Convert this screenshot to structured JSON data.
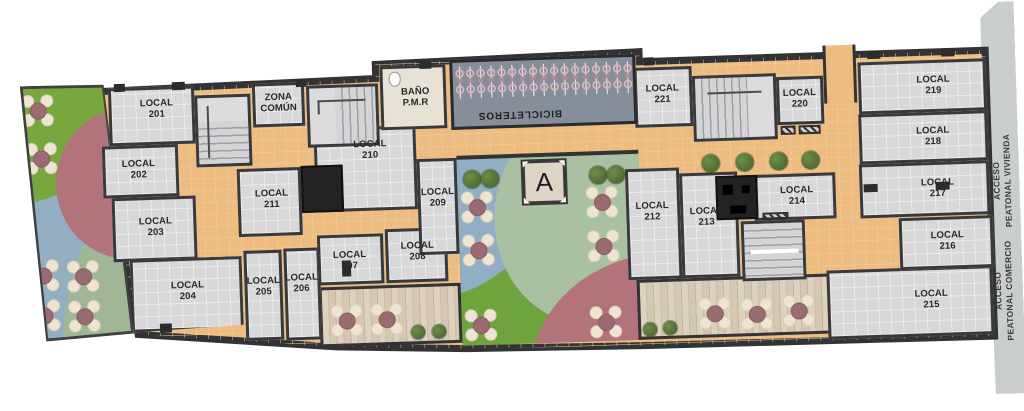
{
  "plan": {
    "locals": [
      {
        "name": "LOCAL",
        "number": "201"
      },
      {
        "name": "LOCAL",
        "number": "202"
      },
      {
        "name": "LOCAL",
        "number": "203"
      },
      {
        "name": "LOCAL",
        "number": "204"
      },
      {
        "name": "LOCAL",
        "number": "205"
      },
      {
        "name": "LOCAL",
        "number": "206"
      },
      {
        "name": "LOCAL",
        "number": "207"
      },
      {
        "name": "LOCAL",
        "number": "208"
      },
      {
        "name": "LOCAL",
        "number": "209"
      },
      {
        "name": "LOCAL",
        "number": "210"
      },
      {
        "name": "LOCAL",
        "number": "211"
      },
      {
        "name": "LOCAL",
        "number": "212"
      },
      {
        "name": "LOCAL",
        "number": "213"
      },
      {
        "name": "LOCAL",
        "number": "214"
      },
      {
        "name": "LOCAL",
        "number": "215"
      },
      {
        "name": "LOCAL",
        "number": "216"
      },
      {
        "name": "LOCAL",
        "number": "217"
      },
      {
        "name": "LOCAL",
        "number": "218"
      },
      {
        "name": "LOCAL",
        "number": "219"
      },
      {
        "name": "LOCAL",
        "number": "220"
      },
      {
        "name": "LOCAL",
        "number": "221"
      }
    ],
    "zones": {
      "zona_comun_line1": "ZONA",
      "zona_comun_line2": "COMÚN",
      "bano_line1": "BAÑO",
      "bano_line2": "P.M.R",
      "bicicleteros": "BICICLETEROS",
      "marker_a": "A"
    },
    "access": {
      "vivienda_line1": "ACCESO",
      "vivienda_line2": "PEATONAL VIVIENDA",
      "comercio_line1": "ACCESO",
      "comercio_line2": "PEATONAL COMERCIO"
    },
    "colors": {
      "wall": "#39393b",
      "room_floor": "#d8d8da",
      "corridor": "#ecbc81",
      "terrace_green": "#78a73e",
      "rose": "#b3737b",
      "blue_gray": "#93aec3",
      "sage": "#9fb795",
      "deck_wood": "#d9cdba",
      "bike_area": "#878e9b",
      "sidewalk": "#c9cdcc"
    }
  }
}
